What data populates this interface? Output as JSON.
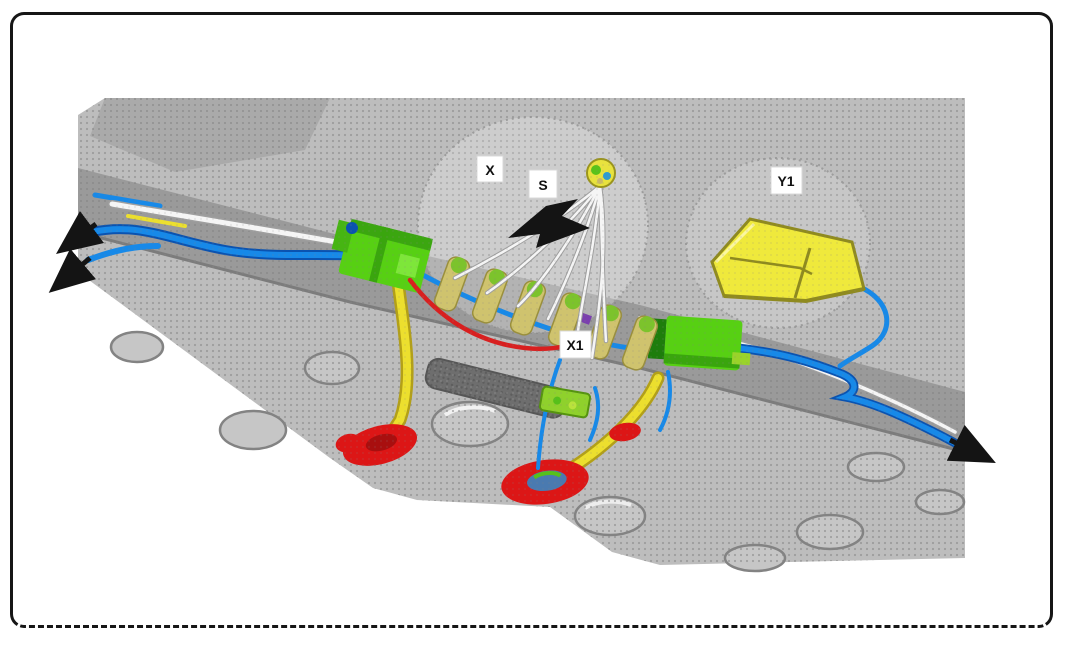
{
  "labels": {
    "detail_x": "X",
    "detail_s": "S",
    "connector_x1": "X1",
    "component_y1": "Y1"
  },
  "colors": {
    "frame": "#161616",
    "page_bg": "#ffffff",
    "casing_base": "#bdbdbd",
    "casing_topleft": "#a7a7a7",
    "casing_dark_band": "#9a9a9a",
    "dot": "#848484",
    "slot": "#6e6e6e",
    "boss_stroke": "#838383",
    "boss_fill": "#c6c6c6",
    "wire_blue": "#1789e8",
    "wire_blue_dark": "#0b53b0",
    "wire_white": "#f5f5f5",
    "wire_gray": "#9f9f9f",
    "wire_red": "#d81f1f",
    "cable_yellow": "#ecdf2e",
    "cable_yellow_dark": "#b3a017",
    "connector_green": "#57d013",
    "connector_green_dark": "#2f9410",
    "solenoid_tan": "#cfc36e",
    "solenoid_green": "#7cc32c",
    "component_yellow": "#efe93c",
    "component_olive": "#8f8a1f",
    "grommet_red": "#dc1616",
    "arrow_black": "#141414",
    "detail_circle": "#9c9c9c",
    "label_bg": "#ffffff",
    "label_text": "#111111"
  }
}
